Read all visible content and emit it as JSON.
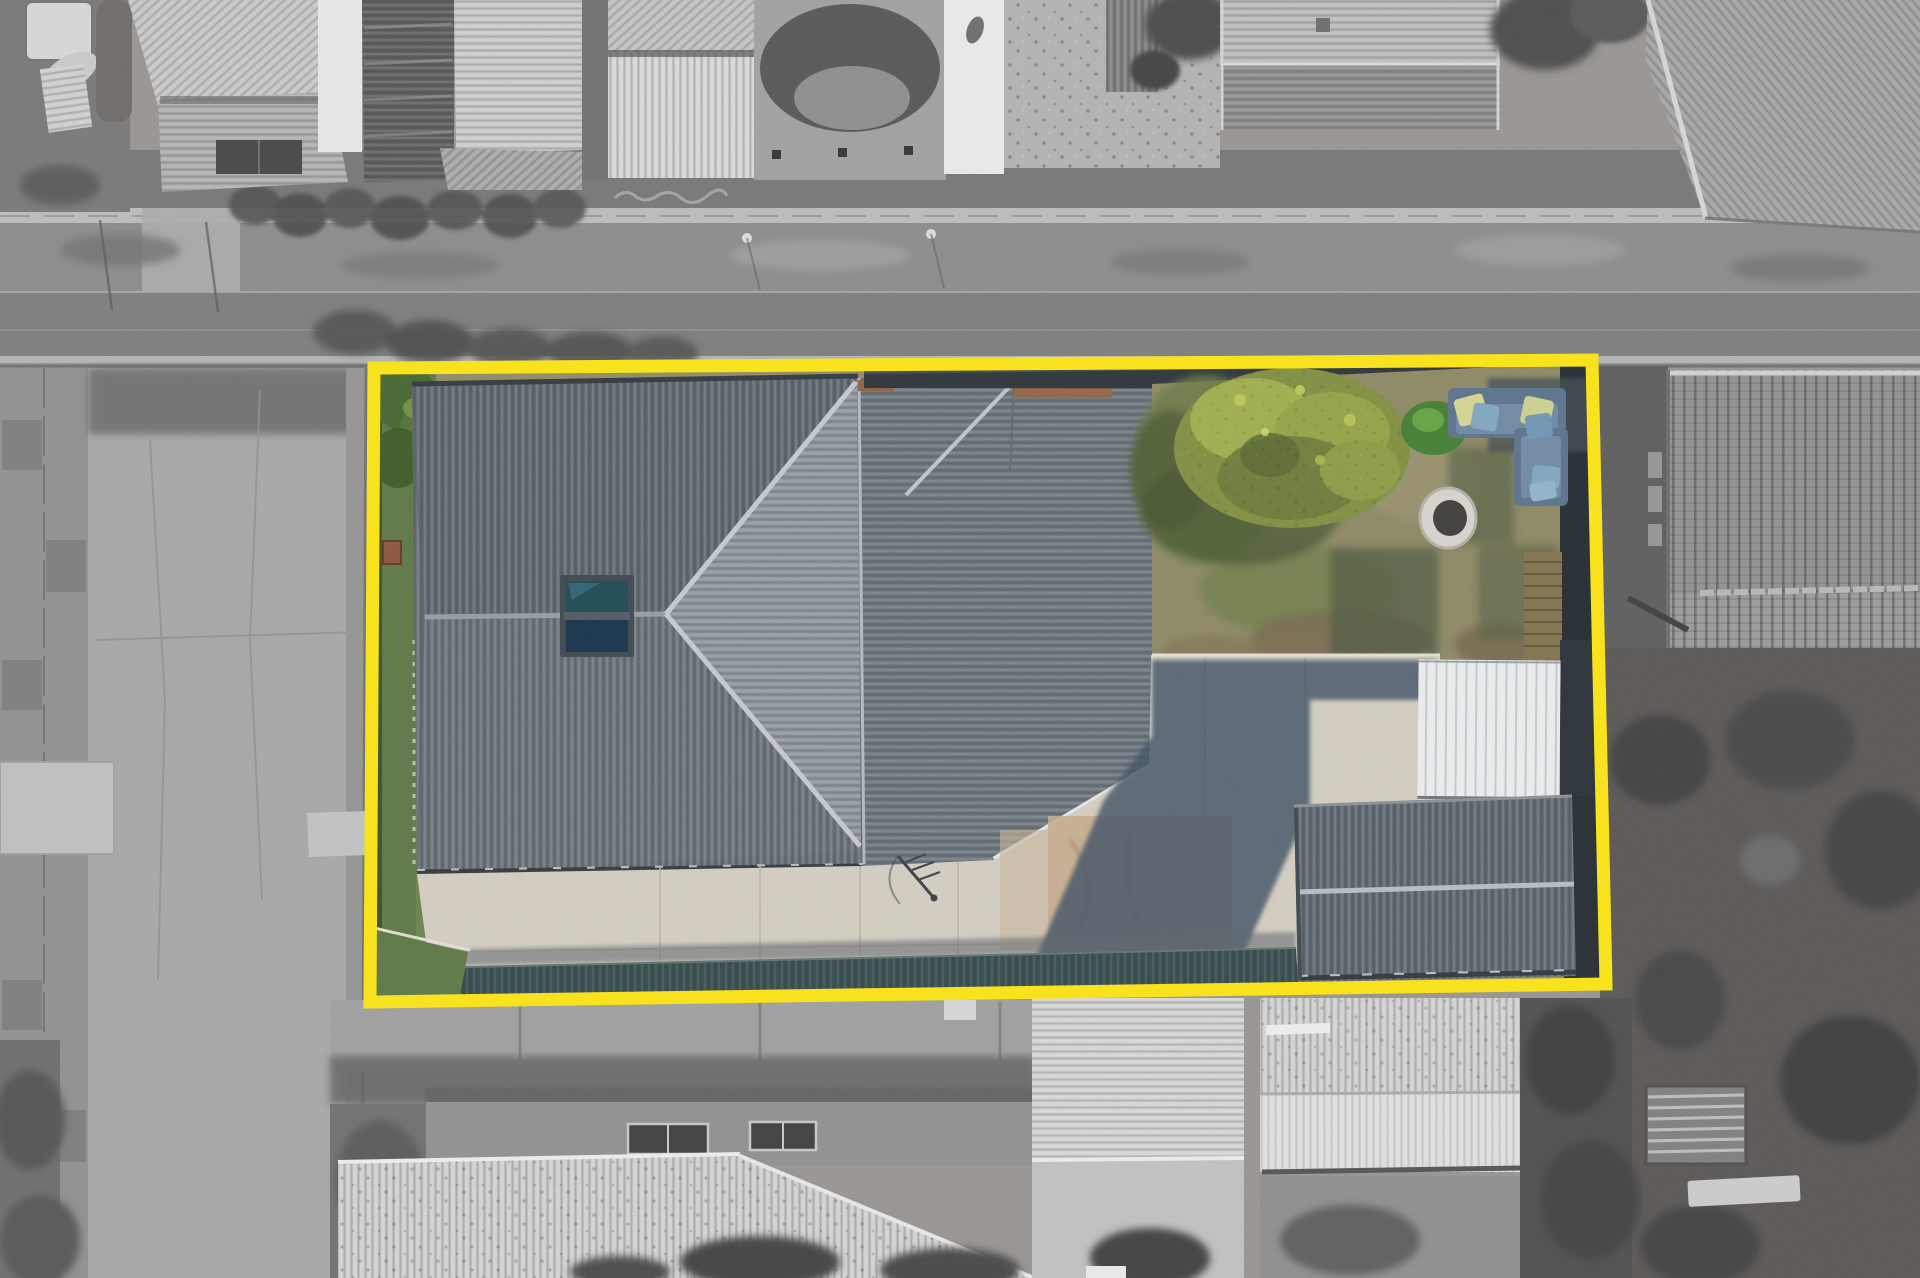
{
  "image": {
    "kind_label": "aerial-drone-photo-with-property-boundary-highlight",
    "width_px": 1920,
    "height_px": 1278
  },
  "overlay": {
    "boundary_color": "#ffe70d",
    "boundary_points": "374,368 1592,360 1606,984 370,1002",
    "boundary_stroke_width": "13"
  },
  "palette": {
    "main_roof": "#636c75",
    "roof_triangle_face": "#8e969d",
    "ridge_cap": "#c6cbcf",
    "rear_roof": "#6a737c",
    "skylight_top": "#17454f",
    "skylight_bottom": "#0e2c46",
    "lawn_green": "#5a7440",
    "backyard_grass": "#8b8660",
    "tree_canopy": "#7e8e3c",
    "shrub_green": "#3e7b2d",
    "concrete": "#d5cfc2",
    "concrete_tan": "#c6ac8d",
    "cast_shadow": "#3b4d60",
    "carport_roof_white": "#eef0f1",
    "garage_roof": "#5c666f",
    "veranda_teal": "#31484a",
    "couch_base": "#56708a",
    "couch_seat": "#6d87a3",
    "cushion_yellow": "#d6d792",
    "cushion_blue": "#7ea6c0",
    "firepit_ring": "#d9d6ce",
    "firepit_center": "#3a3835",
    "deck_wood": "#7f7049",
    "dark_fence": "#1d242b",
    "brick_wall": "#96603f",
    "kennel_brown": "#8a5036",
    "road_gray": "#7b7b7b",
    "footpath_gray": "#bcbcbc",
    "verge_gray": "#8a8a8a",
    "neighbor_roof_light": "#d3d3d3",
    "tiled_roof_gray": "#909090",
    "gray_tree": "#3b3b3b",
    "driveway_gray": "#a7a7a7"
  },
  "scene": {
    "features": [
      "highlighted lot shown in colour inside yellow boundary",
      "surrounding neighbourhood desaturated to grayscale",
      "main house with dark corrugated hip roof and skylight",
      "rear skillion roof section",
      "backyard with olive tree, shrub and stone fire pit",
      "L-shaped outdoor couch with yellow and blue cushions",
      "white carport roof and detached garage with gabled roof",
      "concrete driveway and patio with cast shadows",
      "dark teal veranda strip along lower boundary",
      "street with footpath and grass verges at top",
      "neighbouring grayscale roofs, driveways and trees"
    ]
  }
}
